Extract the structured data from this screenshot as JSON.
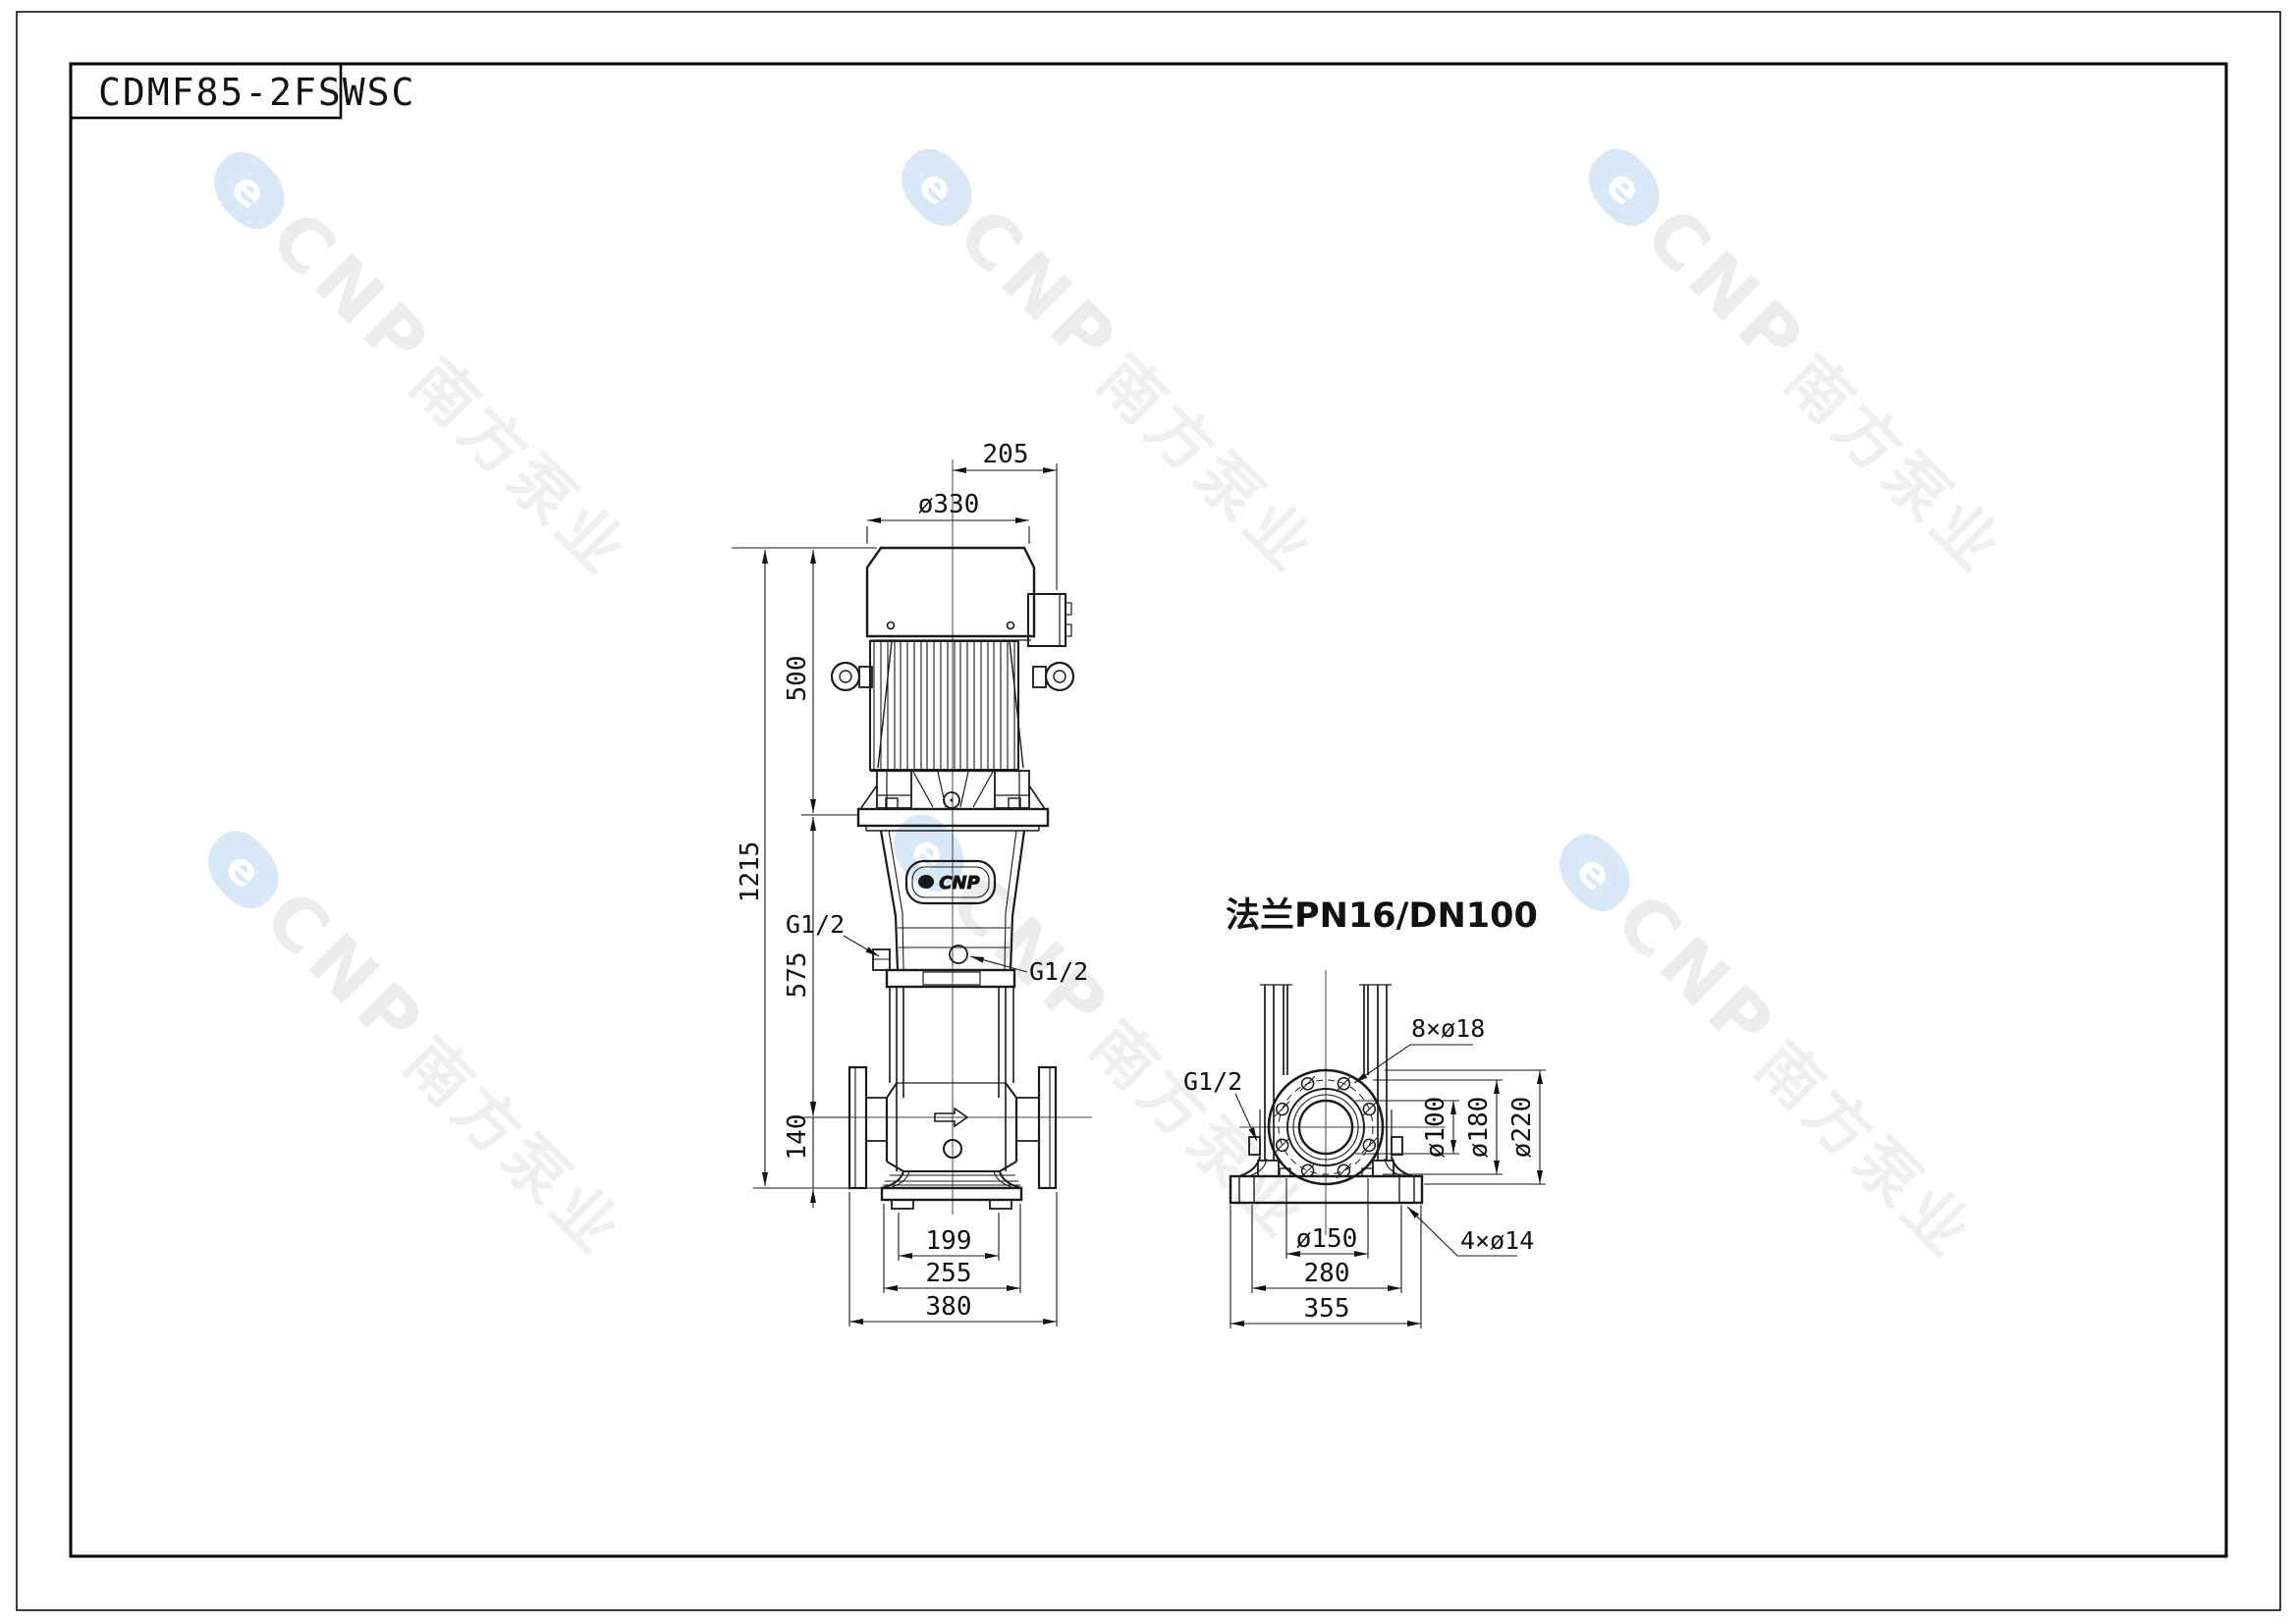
{
  "page": {
    "title": "CDMF85-2FSWSC"
  },
  "watermark": {
    "logo_glyph": "e",
    "brand": "CNP",
    "brand_cn": "南方泵业",
    "logo_color": "#d9e8f6",
    "text_color": "#ececec"
  },
  "side_view": {
    "badge": {
      "logo_glyph": "e",
      "brand": "CNP"
    },
    "labels": {
      "port_left": "G1/2",
      "port_right": "G1/2"
    },
    "dims": {
      "top_offset": "205",
      "motor_dia": "ø330",
      "motor_height": "500",
      "total_height": "1215",
      "mid_height": "575",
      "port_height": "140",
      "foot_span": "199",
      "base_width": "255",
      "overall_width": "380"
    }
  },
  "flange_view": {
    "title": "法兰PN16/DN100",
    "labels": {
      "bolt_holes": "8×ø18",
      "port": "G1/2",
      "base_holes": "4×ø14"
    },
    "dims": {
      "bore": "ø100",
      "bolt_circle": "ø180",
      "outer_dia": "ø220",
      "foot_circle": "ø150",
      "slot_span": "280",
      "base_width": "355"
    }
  }
}
